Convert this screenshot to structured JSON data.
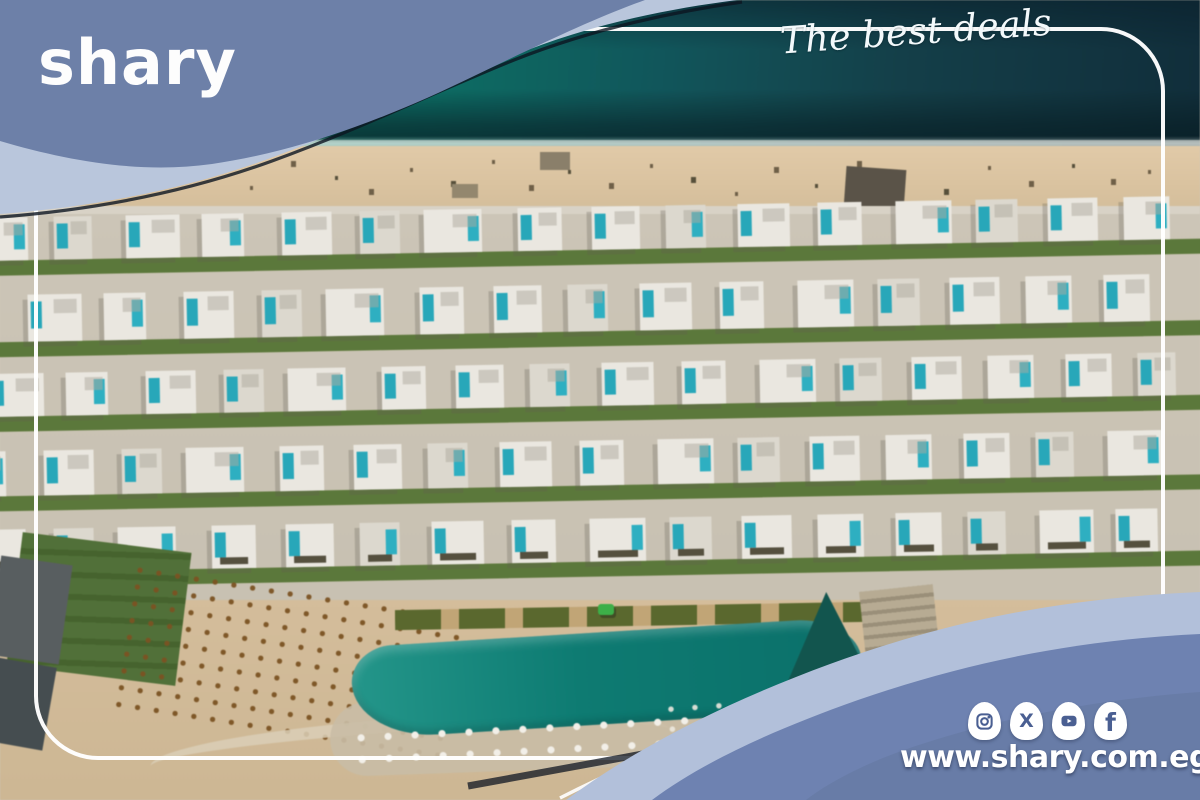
{
  "brand": {
    "logo": "shary",
    "tagline": "The best deals",
    "website": "www.shary.com.eg"
  },
  "social": {
    "icons": [
      {
        "name": "instagram-icon"
      },
      {
        "name": "x-icon",
        "glyph": "X"
      },
      {
        "name": "youtube-icon"
      },
      {
        "name": "facebook-icon",
        "glyph": "f"
      }
    ]
  },
  "colors": {
    "slate_blue_blob": "#6d80a8",
    "light_blue_band": "#b9c6dc",
    "wave_slate": "#6e82b1",
    "wave_light": "#b2c0da",
    "dark_rim": "#0d1520",
    "teal_villa_accent": "#2ba6b8",
    "sea_teal": "#0c7d6e",
    "sea_dark": "#122e3a",
    "beach_sand": "#d9c3a1",
    "lawn_green": "#5c783c",
    "pool_teal": "#107a72",
    "frame_white": "#ffffff",
    "icon_glyph_blue": "#4a5f92",
    "text_white": "#ffffff"
  }
}
